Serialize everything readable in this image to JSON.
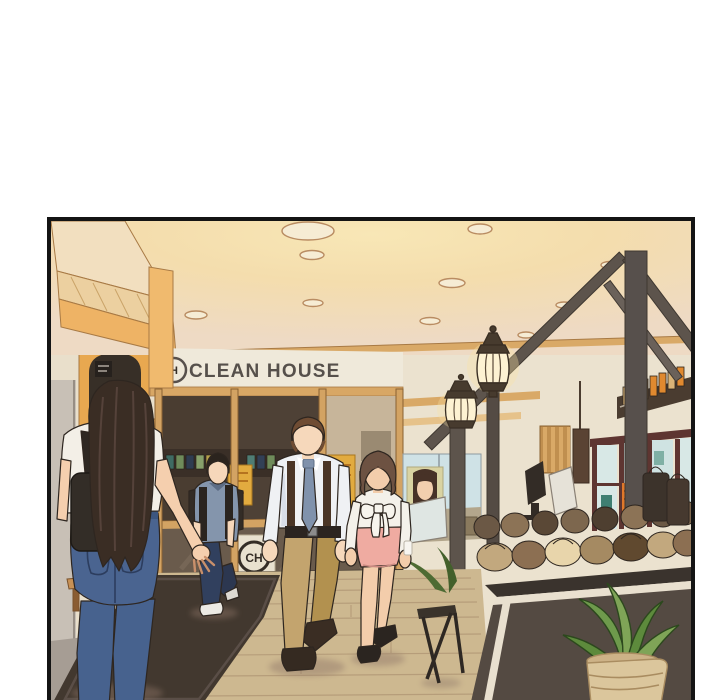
{
  "page": {
    "background": "#ffffff"
  },
  "panel": {
    "border_color": "#141414"
  },
  "signs": {
    "store_name": "CLEAN HOUSE",
    "fascia_logo_letter": "H",
    "glass_logo_letters": "CH"
  },
  "palette": {
    "ceiling_glow": "#f8e7b6",
    "ceiling_edge": "#eedac4",
    "wall_cream": "#ebe2cf",
    "wood_trim": "#d9a967",
    "accent_orange": "#eeb365",
    "pergola_wood": "#5d544c",
    "poster_yellow": "#e2ab3f",
    "maroon_frame": "#5e3531",
    "floor_wood": "#cdb890",
    "rug_dark": "#42382f",
    "jeans_blue": "#4a6490",
    "skirt_pink": "#efaba1",
    "counter_dark": "#544a42",
    "lantern_glow": "#fdf2d2"
  }
}
